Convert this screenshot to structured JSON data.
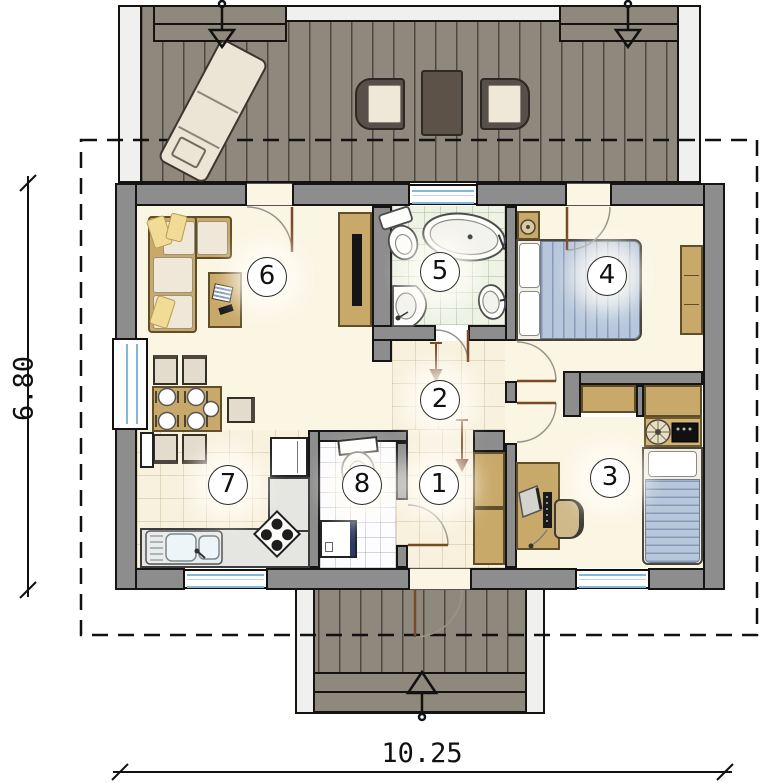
{
  "plan": {
    "title": "single-storey house floor plan with terrace",
    "rooms": [
      {
        "label": "1"
      },
      {
        "label": "2"
      },
      {
        "label": "3"
      },
      {
        "label": "4"
      },
      {
        "label": "5"
      },
      {
        "label": "6"
      },
      {
        "label": "7"
      },
      {
        "label": "8"
      }
    ],
    "dimensions": {
      "width_label": "10.25",
      "height_label": "6.80"
    },
    "colors": {
      "wall_gray": "#8d8d8d",
      "deck_plank": "#8f887c",
      "floor_cream": "#fbf5e4",
      "hall_tile": "#f8f1de",
      "bath_tile": "#eef3e6",
      "wc_tile": "#fdfdff",
      "furniture_wood": "#c9a96a",
      "bed_blue": "#b7c6da",
      "window_blue": "#85b8d8",
      "door_leaf_brown": "#7a4a28",
      "dark_brown": "#5d5247",
      "pillow_yellow": "#f0db97",
      "outline_black": "#151515"
    }
  }
}
